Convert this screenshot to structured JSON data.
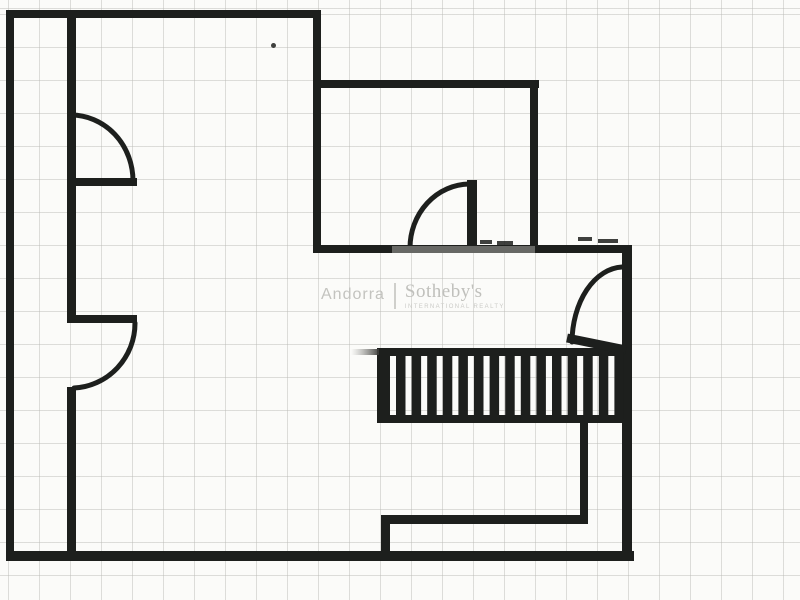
{
  "watermark": {
    "location": "Andorra",
    "brand": "Sotheby's",
    "brand_sub": "INTERNATIONAL REALTY",
    "text_color": "#c3c3bf"
  },
  "paper": {
    "background": "#fbfbf9",
    "grid_color": "rgba(183,183,178,0.45)",
    "grid_spacing_x": 31,
    "grid_spacing_y": 33,
    "grid_offset_x": 8,
    "grid_offset_y": 14
  },
  "plan": {
    "wall_color": "#1d1f1d",
    "arc_stroke_width": 5,
    "walls": [
      {
        "name": "top-outer-wall",
        "x": 6,
        "y": 10,
        "w": 315,
        "h": 8
      },
      {
        "name": "left-outer-wall",
        "x": 6,
        "y": 10,
        "w": 8,
        "h": 548
      },
      {
        "name": "interior-wall-upper",
        "x": 67,
        "y": 12,
        "w": 9,
        "h": 311
      },
      {
        "name": "interior-wall-lower",
        "x": 67,
        "y": 387,
        "w": 9,
        "h": 167
      },
      {
        "name": "door-1-stub-wall",
        "x": 70,
        "y": 178,
        "w": 67,
        "h": 8
      },
      {
        "name": "door-2-stub-wall",
        "x": 70,
        "y": 315,
        "w": 67,
        "h": 8
      },
      {
        "name": "room2-left-wall",
        "x": 313,
        "y": 10,
        "w": 8,
        "h": 243
      },
      {
        "name": "room2-top-wall",
        "x": 313,
        "y": 80,
        "w": 226,
        "h": 8
      },
      {
        "name": "room2-right-wall",
        "x": 530,
        "y": 80,
        "w": 8,
        "h": 173
      },
      {
        "name": "mid-horizontal-wall",
        "x": 313,
        "y": 245,
        "w": 319,
        "h": 8
      },
      {
        "name": "door-3-leaf",
        "x": 467,
        "y": 180,
        "w": 10,
        "h": 70
      },
      {
        "name": "right-outer-wall",
        "x": 622,
        "y": 245,
        "w": 10,
        "h": 316
      },
      {
        "name": "bottom-outer-wall",
        "x": 6,
        "y": 551,
        "w": 628,
        "h": 10
      },
      {
        "name": "stair-top-rail",
        "x": 377,
        "y": 348,
        "w": 251,
        "h": 8
      },
      {
        "name": "stair-bottom-rail",
        "x": 377,
        "y": 415,
        "w": 251,
        "h": 8
      },
      {
        "name": "stair-left-post",
        "x": 377,
        "y": 348,
        "w": 13,
        "h": 75
      },
      {
        "name": "hall-wall-vertical",
        "x": 580,
        "y": 423,
        "w": 8,
        "h": 98
      },
      {
        "name": "hall-wall-horizontal",
        "x": 383,
        "y": 515,
        "w": 205,
        "h": 9
      },
      {
        "name": "hall-wall-stub",
        "x": 381,
        "y": 515,
        "w": 9,
        "h": 44
      }
    ],
    "door_arcs": [
      {
        "name": "door-1-swing-arc",
        "d": "M 71 115 A 62 66 0 0 1 133 181"
      },
      {
        "name": "door-2-swing-arc",
        "d": "M 135 323 A 64 65 0 0 1 74 388"
      },
      {
        "name": "door-3-swing-arc",
        "d": "M 469 184 A 60 64 0 0 0 410 248"
      },
      {
        "name": "door-4-swing-arc",
        "d": "M 622 267 A 52 76 0 0 0 572 342"
      }
    ],
    "door_leaf_line": {
      "name": "door-4-leaf",
      "x1": 567,
      "y1": 338,
      "x2": 626,
      "y2": 350,
      "stroke_width": 9
    },
    "stairs": {
      "tread_count": 15,
      "x0": 396,
      "period": 15.6,
      "bar_width": 9.5,
      "y": 352,
      "height": 67
    },
    "gray_patches": [
      {
        "name": "stair-rail-fade",
        "x": 351,
        "y": 349,
        "w": 28,
        "h": 6,
        "gradient": true
      },
      {
        "name": "wall-scan-fade",
        "x": 392,
        "y": 246,
        "w": 143,
        "h": 7,
        "fill": "#9a9a96",
        "opacity": 0.6
      }
    ],
    "smudges": [
      {
        "name": "scan-smudge",
        "x": 480,
        "y": 240,
        "w": 12,
        "h": 4
      },
      {
        "name": "scan-smudge",
        "x": 497,
        "y": 241,
        "w": 16,
        "h": 4
      },
      {
        "name": "scan-smudge",
        "x": 578,
        "y": 237,
        "w": 14,
        "h": 4
      },
      {
        "name": "scan-smudge",
        "x": 598,
        "y": 239,
        "w": 20,
        "h": 4
      },
      {
        "name": "scan-speck",
        "x": 271,
        "y": 43,
        "w": 5,
        "h": 5,
        "round": true
      }
    ]
  }
}
